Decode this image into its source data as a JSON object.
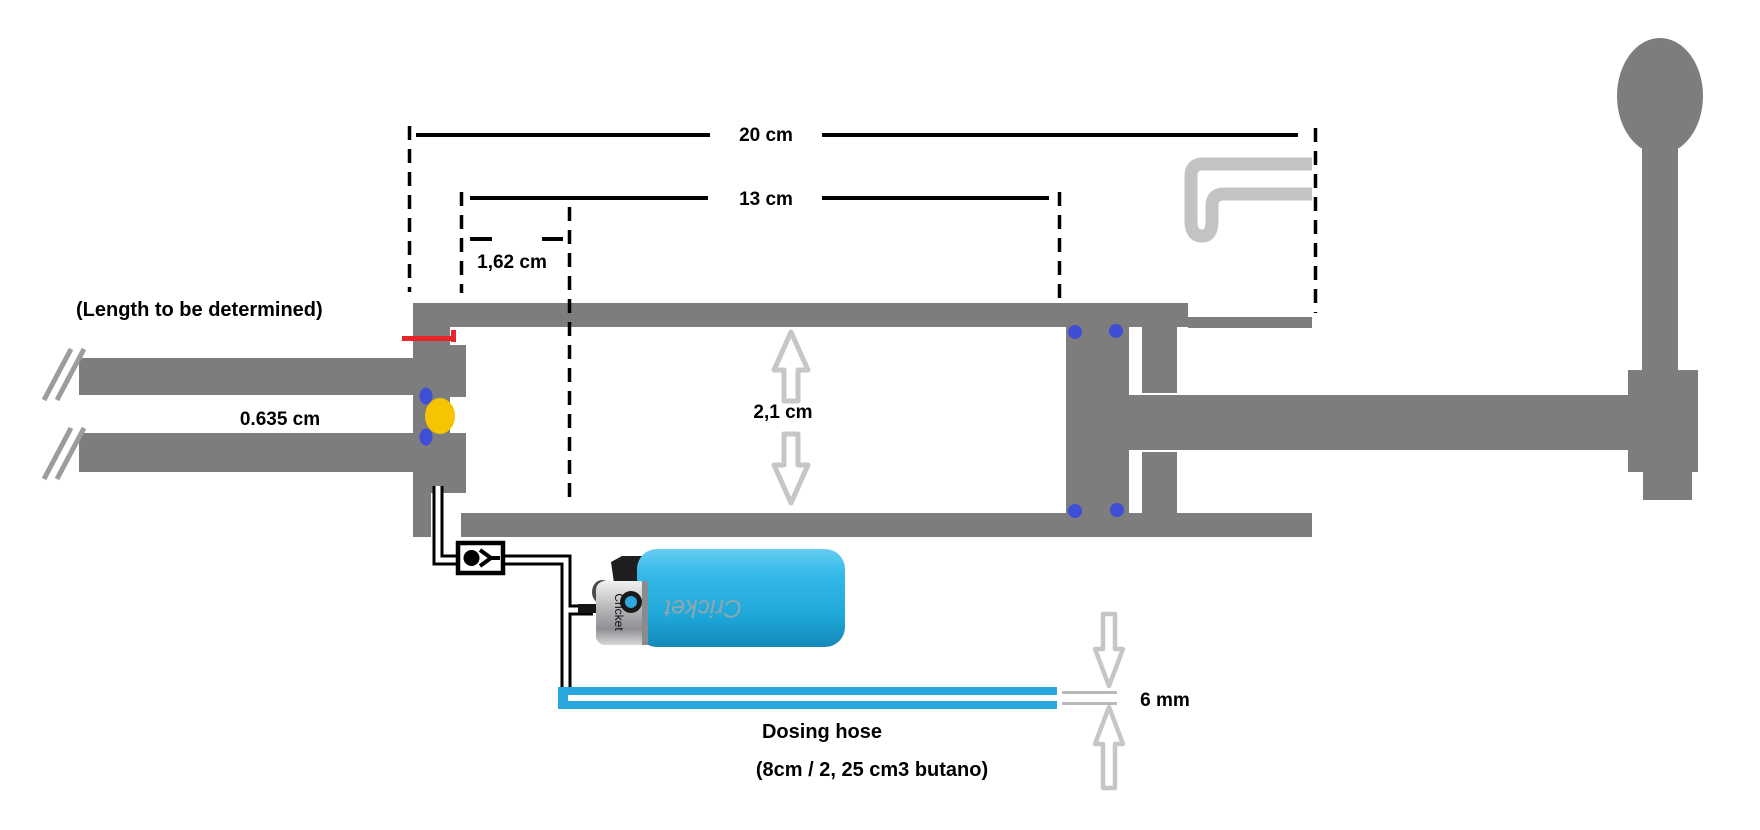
{
  "diagram": {
    "dimensions": {
      "total_length": "20 cm",
      "chamber_length": "13 cm",
      "seat_offset": "1,62 cm",
      "chamber_bore": "2,1 cm",
      "barrel_bore": "0.635 cm",
      "hose_diameter": "6 mm"
    },
    "notes": {
      "barrel_length_note": "(Length to be determined)",
      "hose_label": "Dosing hose",
      "hose_capacity": "(8cm / 2, 25 cm3 butano)"
    },
    "lighter": {
      "brand_body": "Cricket",
      "brand_cap": "Cricket"
    },
    "colors": {
      "structure_gray": "#7d7d7d",
      "accent_light_gray": "#c3c3c3",
      "arrow_gray": "#c6c6c6",
      "hose_blue": "#2aa7df",
      "seal_blue": "#3e4fd6",
      "ball_yellow": "#f6c400",
      "marker_red": "#e8232a",
      "lighter_cyan": "#29b1e3"
    }
  }
}
